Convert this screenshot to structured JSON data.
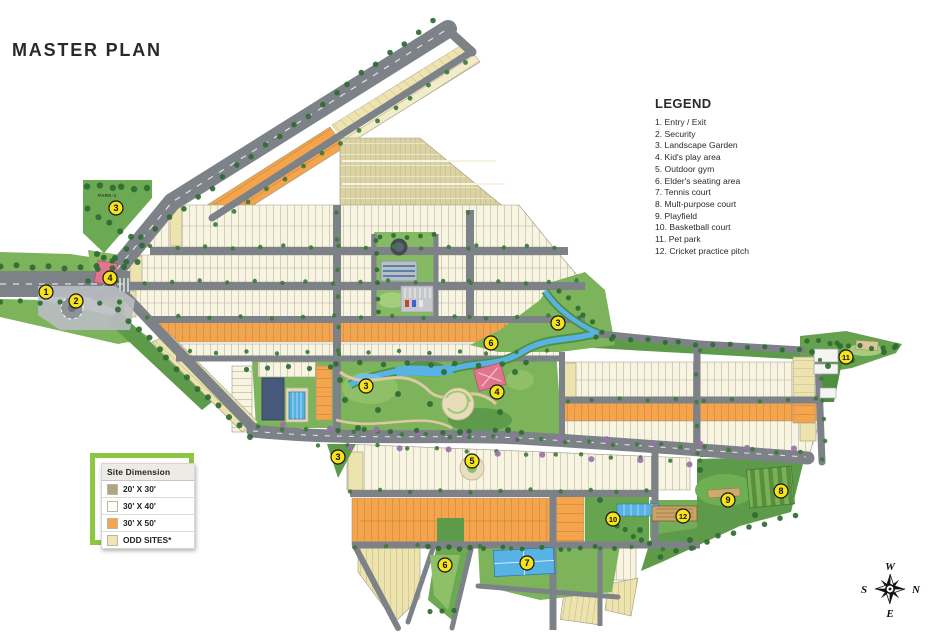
{
  "title": "MASTER PLAN",
  "park_label": "PARK-1",
  "legend": {
    "title": "LEGEND",
    "items": [
      "1. Entry / Exit",
      "2. Security",
      "3. Landscape Garden",
      "4. Kid's play area",
      "5. Outdoor gym",
      "6. Elder's seating area",
      "7. Tennis court",
      "8. Mult-purpose court",
      "9. Playfield",
      "10. Basketball court",
      "11. Pet park",
      "12. Cricket practice pitch"
    ]
  },
  "site_dimension": {
    "header": "Site Dimension",
    "rows": [
      {
        "label": "20' X 30'",
        "color": "#b2a47c"
      },
      {
        "label": "30' X 40'",
        "color": "#fdfdf6"
      },
      {
        "label": "30' X 50'",
        "color": "#f5a54e"
      },
      {
        "label": "ODD SITES*",
        "color": "#efe6b4"
      }
    ]
  },
  "compass": {
    "top": "W",
    "right": "N",
    "bottom": "E",
    "left": "S"
  },
  "markers": [
    {
      "n": "1",
      "x": 46,
      "y": 292
    },
    {
      "n": "2",
      "x": 76,
      "y": 301
    },
    {
      "n": "4",
      "x": 110,
      "y": 278
    },
    {
      "n": "3",
      "x": 116,
      "y": 208
    },
    {
      "n": "3",
      "x": 366,
      "y": 386
    },
    {
      "n": "3",
      "x": 558,
      "y": 323
    },
    {
      "n": "3",
      "x": 338,
      "y": 457
    },
    {
      "n": "4",
      "x": 497,
      "y": 392
    },
    {
      "n": "5",
      "x": 472,
      "y": 461
    },
    {
      "n": "6",
      "x": 491,
      "y": 343
    },
    {
      "n": "6",
      "x": 445,
      "y": 565
    },
    {
      "n": "7",
      "x": 527,
      "y": 563
    },
    {
      "n": "8",
      "x": 781,
      "y": 491
    },
    {
      "n": "9",
      "x": 728,
      "y": 500
    },
    {
      "n": "10",
      "x": 613,
      "y": 519
    },
    {
      "n": "11",
      "x": 846,
      "y": 357
    },
    {
      "n": "12",
      "x": 683,
      "y": 516
    }
  ],
  "colors": {
    "marker_fill": "#f7e21b",
    "road": "#7d8188",
    "plot_cream": "#f8f4e2",
    "plot_orange": "#f3a44c",
    "plot_khaki": "#ece3ae",
    "plot_tan": "#b2a47c",
    "green": "#7cb35b",
    "green_dark": "#4e8f3f",
    "water": "#58b2e4",
    "frame_green": "#8dc63f"
  }
}
